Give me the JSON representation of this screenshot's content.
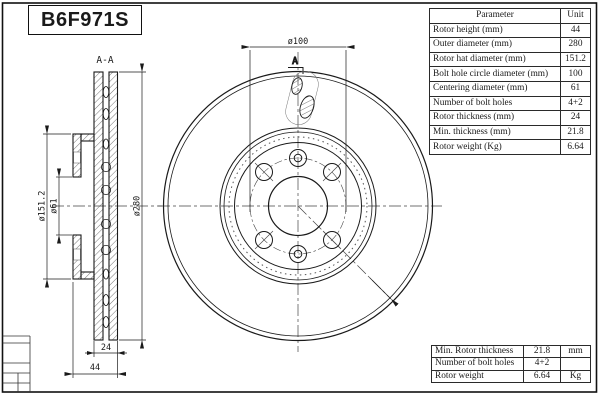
{
  "title": "B6F971S",
  "colors": {
    "ink": "#1a1a1a",
    "background": "#ffffff"
  },
  "drawing": {
    "section_label": "A-A",
    "cut_arrow_label": "A",
    "dim_bolt_circle": "ø100",
    "dim_outer_diameter": "ø280",
    "dim_hat_diameter": "ø151.2",
    "dim_centering_diameter": "ø61",
    "dim_rotor_thickness": "24",
    "dim_rotor_height": "44"
  },
  "parameter_table": {
    "header": {
      "parameter": "Parameter",
      "unit": "Unit"
    },
    "rows": [
      {
        "label": "Rotor height (mm)",
        "value": "44"
      },
      {
        "label": "Outer diameter (mm)",
        "value": "280"
      },
      {
        "label": "Rotor hat diameter (mm)",
        "value": "151.2"
      },
      {
        "label": "Bolt hole circle diameter (mm)",
        "value": "100"
      },
      {
        "label": "Centering diameter (mm)",
        "value": "61"
      },
      {
        "label": "Number of bolt holes",
        "value": "4+2"
      },
      {
        "label": "Rotor thickness (mm)",
        "value": "24"
      },
      {
        "label": "Min. thickness (mm)",
        "value": "21.8"
      },
      {
        "label": "Rotor weight (Kg)",
        "value": "6.64"
      }
    ]
  },
  "summary_table": {
    "rows": [
      {
        "label": "Min. Rotor thickness",
        "value": "21.8",
        "unit": "mm"
      },
      {
        "label": "Number of bolt holes",
        "value": "4+2",
        "unit": ""
      },
      {
        "label": "Rotor weight",
        "value": "6.64",
        "unit": "Kg"
      }
    ]
  }
}
